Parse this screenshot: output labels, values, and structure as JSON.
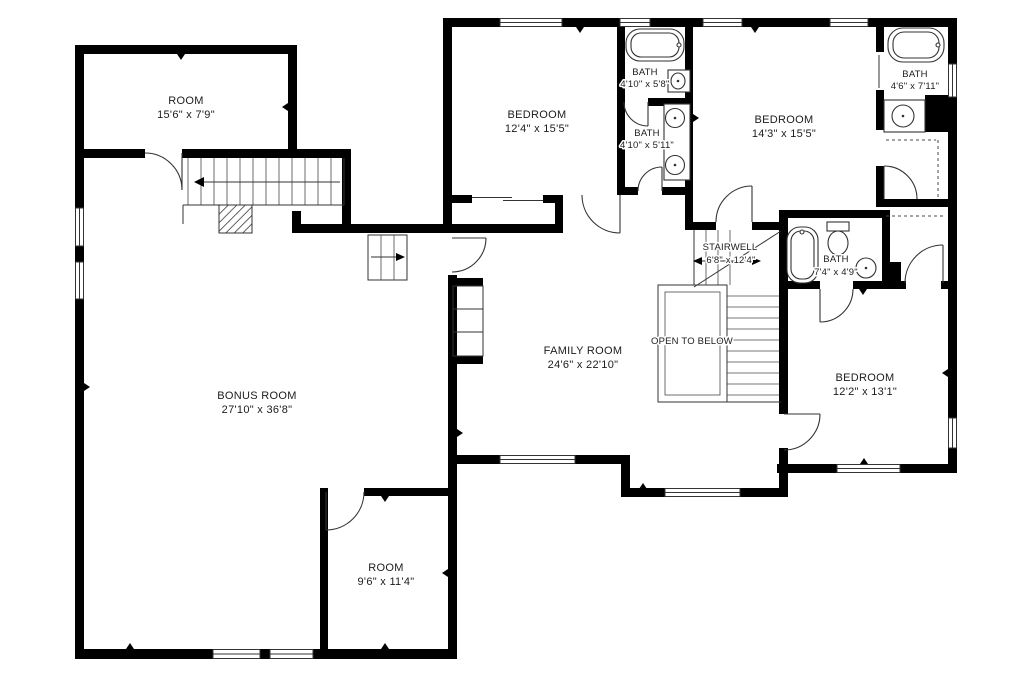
{
  "palette": {
    "wall": "#000000",
    "line": "#333333",
    "text": "#1c1c1c",
    "bg": "#ffffff"
  },
  "plan_title": "Second floor plan",
  "rooms": [
    {
      "id": "room-upper-left",
      "name": "ROOM",
      "dims": "15'6\" x 7'9\""
    },
    {
      "id": "bedroom-top-middle",
      "name": "BEDROOM",
      "dims": "12'4\" x 15'5\""
    },
    {
      "id": "bath-top-front",
      "name": "BATH",
      "dims": "4'10\" x 5'8\""
    },
    {
      "id": "bath-top-back",
      "name": "BATH",
      "dims": "4'10\" x 5'11\""
    },
    {
      "id": "bedroom-top-right",
      "name": "BEDROOM",
      "dims": "14'3\" x 15'5\""
    },
    {
      "id": "bath-top-corner",
      "name": "BATH",
      "dims": "4'6\" x 7'11\""
    },
    {
      "id": "stairwell",
      "name": "STAIRWELL",
      "dims": "6'8\" x 12'4\""
    },
    {
      "id": "open-to-below",
      "name": "OPEN TO BELOW",
      "dims": ""
    },
    {
      "id": "bath-middle",
      "name": "BATH",
      "dims": "7'4\" x 4'9\""
    },
    {
      "id": "family-room",
      "name": "FAMILY ROOM",
      "dims": "24'6\" x 22'10\""
    },
    {
      "id": "bedroom-bottom-right",
      "name": "BEDROOM",
      "dims": "12'2\" x 13'1\""
    },
    {
      "id": "bonus-room",
      "name": "BONUS ROOM",
      "dims": "27'10\" x 36'8\""
    },
    {
      "id": "room-bottom",
      "name": "ROOM",
      "dims": "9'6\" x 11'4\""
    }
  ]
}
